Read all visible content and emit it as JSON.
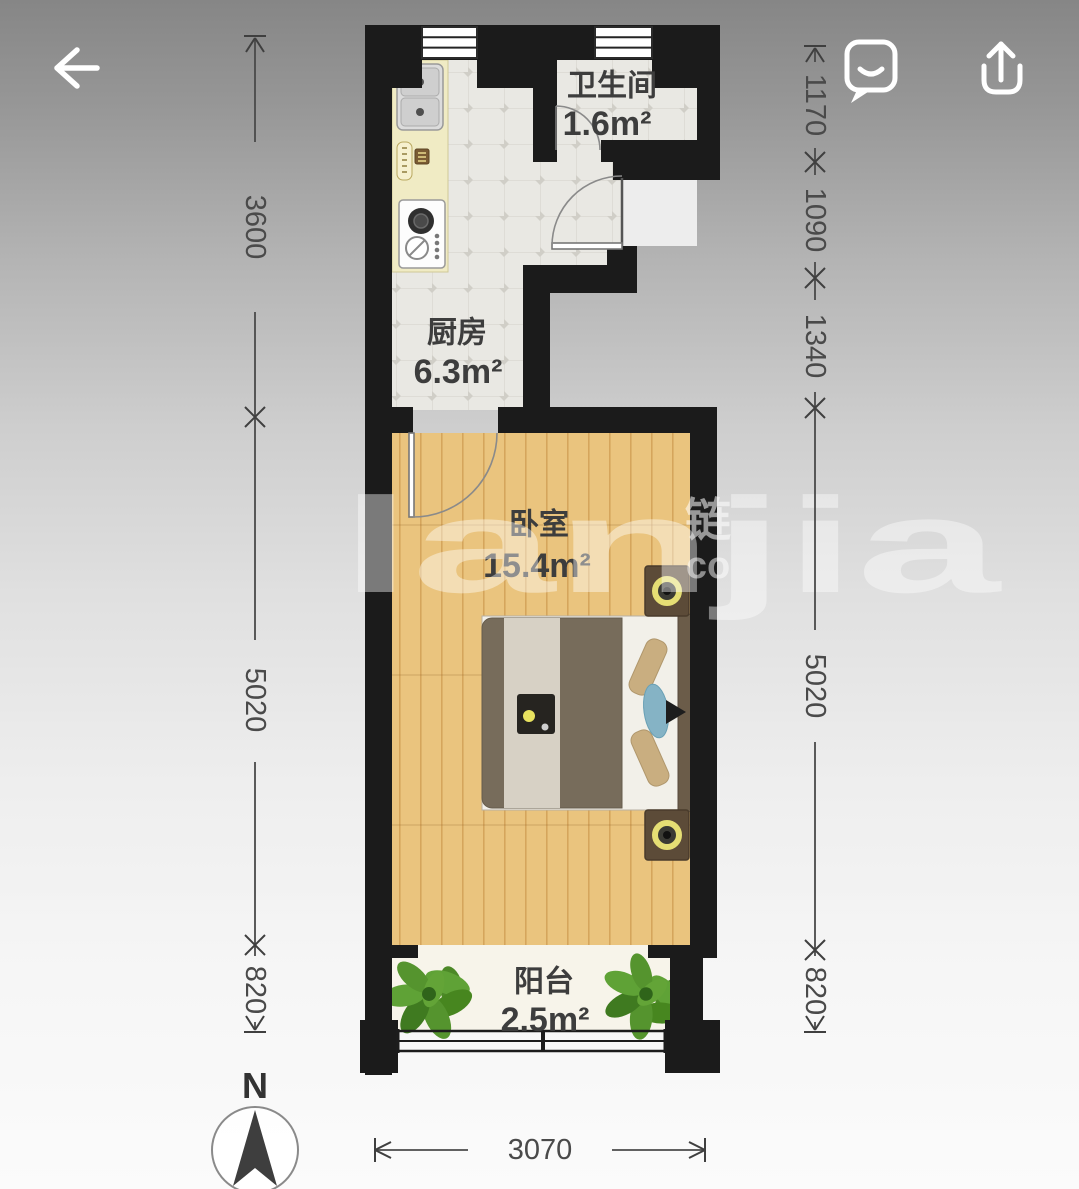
{
  "header": {
    "back_icon": "back-arrow",
    "feedback_icon": "chat-bubble-smile",
    "share_icon": "share-up-arrow"
  },
  "floor_plan": {
    "rooms": [
      {
        "name": "卫生间",
        "area": "1.6m²"
      },
      {
        "name": "厨房",
        "area": "6.3m²"
      },
      {
        "name": "卧室",
        "area": "15.4m²"
      },
      {
        "name": "阳台",
        "area": "2.5m²"
      }
    ],
    "dimensions_left": [
      "3600",
      "5020",
      "820"
    ],
    "dimensions_right": [
      "1170",
      "1090",
      "1340",
      "5020",
      "820"
    ],
    "dimension_bottom": "3070",
    "compass_label": "N"
  },
  "watermark": {
    "main": "lanjia",
    "cjk": "链",
    "suffix": "co"
  },
  "colors": {
    "wall": "#1b1b1b",
    "tile_floor": "#e9e8e3",
    "wood_floor": "#eac47e",
    "balcony_floor": "#f7f4ea",
    "kitchen_counter": "#f0ebc4",
    "dimension_text": "#4a4a4a",
    "room_text": "#3d3d3d",
    "plant_green": "#55942e",
    "lamp_yellow": "#e5de74",
    "background_top": "#868686",
    "background_bottom": "#fbfbfb"
  }
}
